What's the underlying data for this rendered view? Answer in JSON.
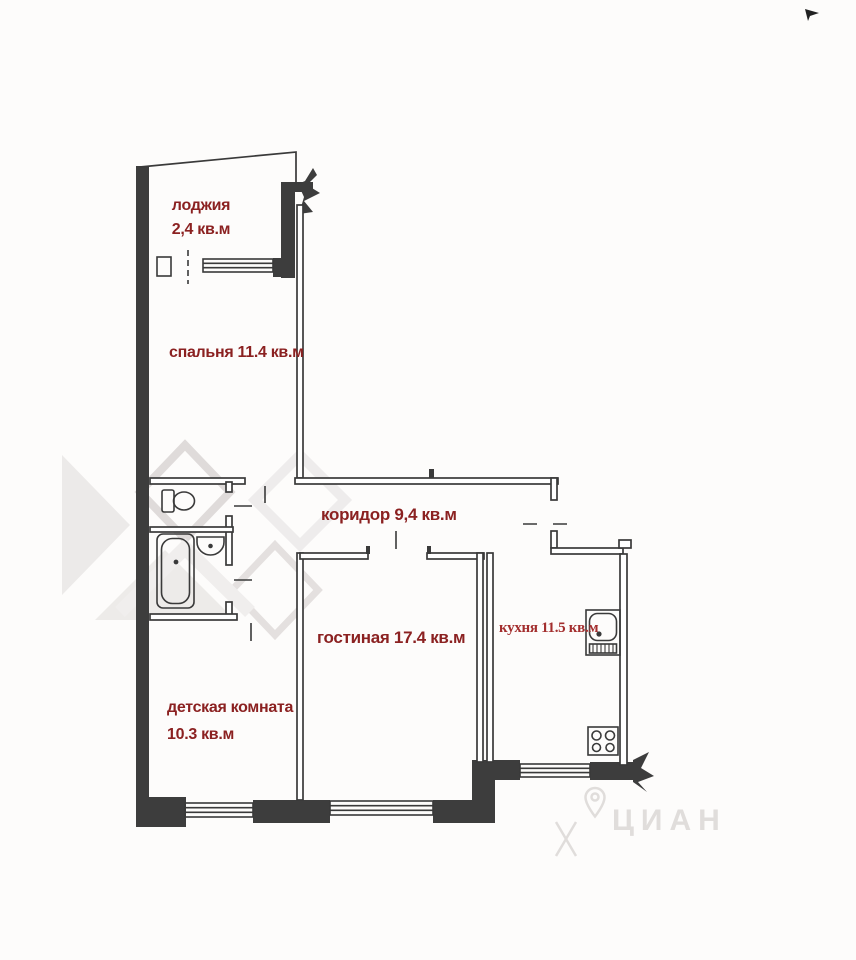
{
  "plan": {
    "rooms": [
      {
        "name": "loggia",
        "label_line1": "лоджия",
        "label_line2": "2,4 кв.м"
      },
      {
        "name": "bedroom",
        "label": "спальня 11.4 кв.м"
      },
      {
        "name": "corridor",
        "label": "коридор 9,4 кв.м"
      },
      {
        "name": "living_room",
        "label": "гостиная 17.4 кв.м"
      },
      {
        "name": "kitchen",
        "label": "кухня 11.5 кв.м"
      },
      {
        "name": "children_room",
        "label_line1": "детская комната",
        "label_line2": "10.3 кв.м"
      }
    ],
    "watermark_text": "ЦИАН",
    "colors": {
      "label_maroon": "#8b2121",
      "label_kitchen_red": "#a32e2e",
      "wall_dark": "#3d3d3d",
      "watermark_gray": "#eae7e6"
    }
  }
}
